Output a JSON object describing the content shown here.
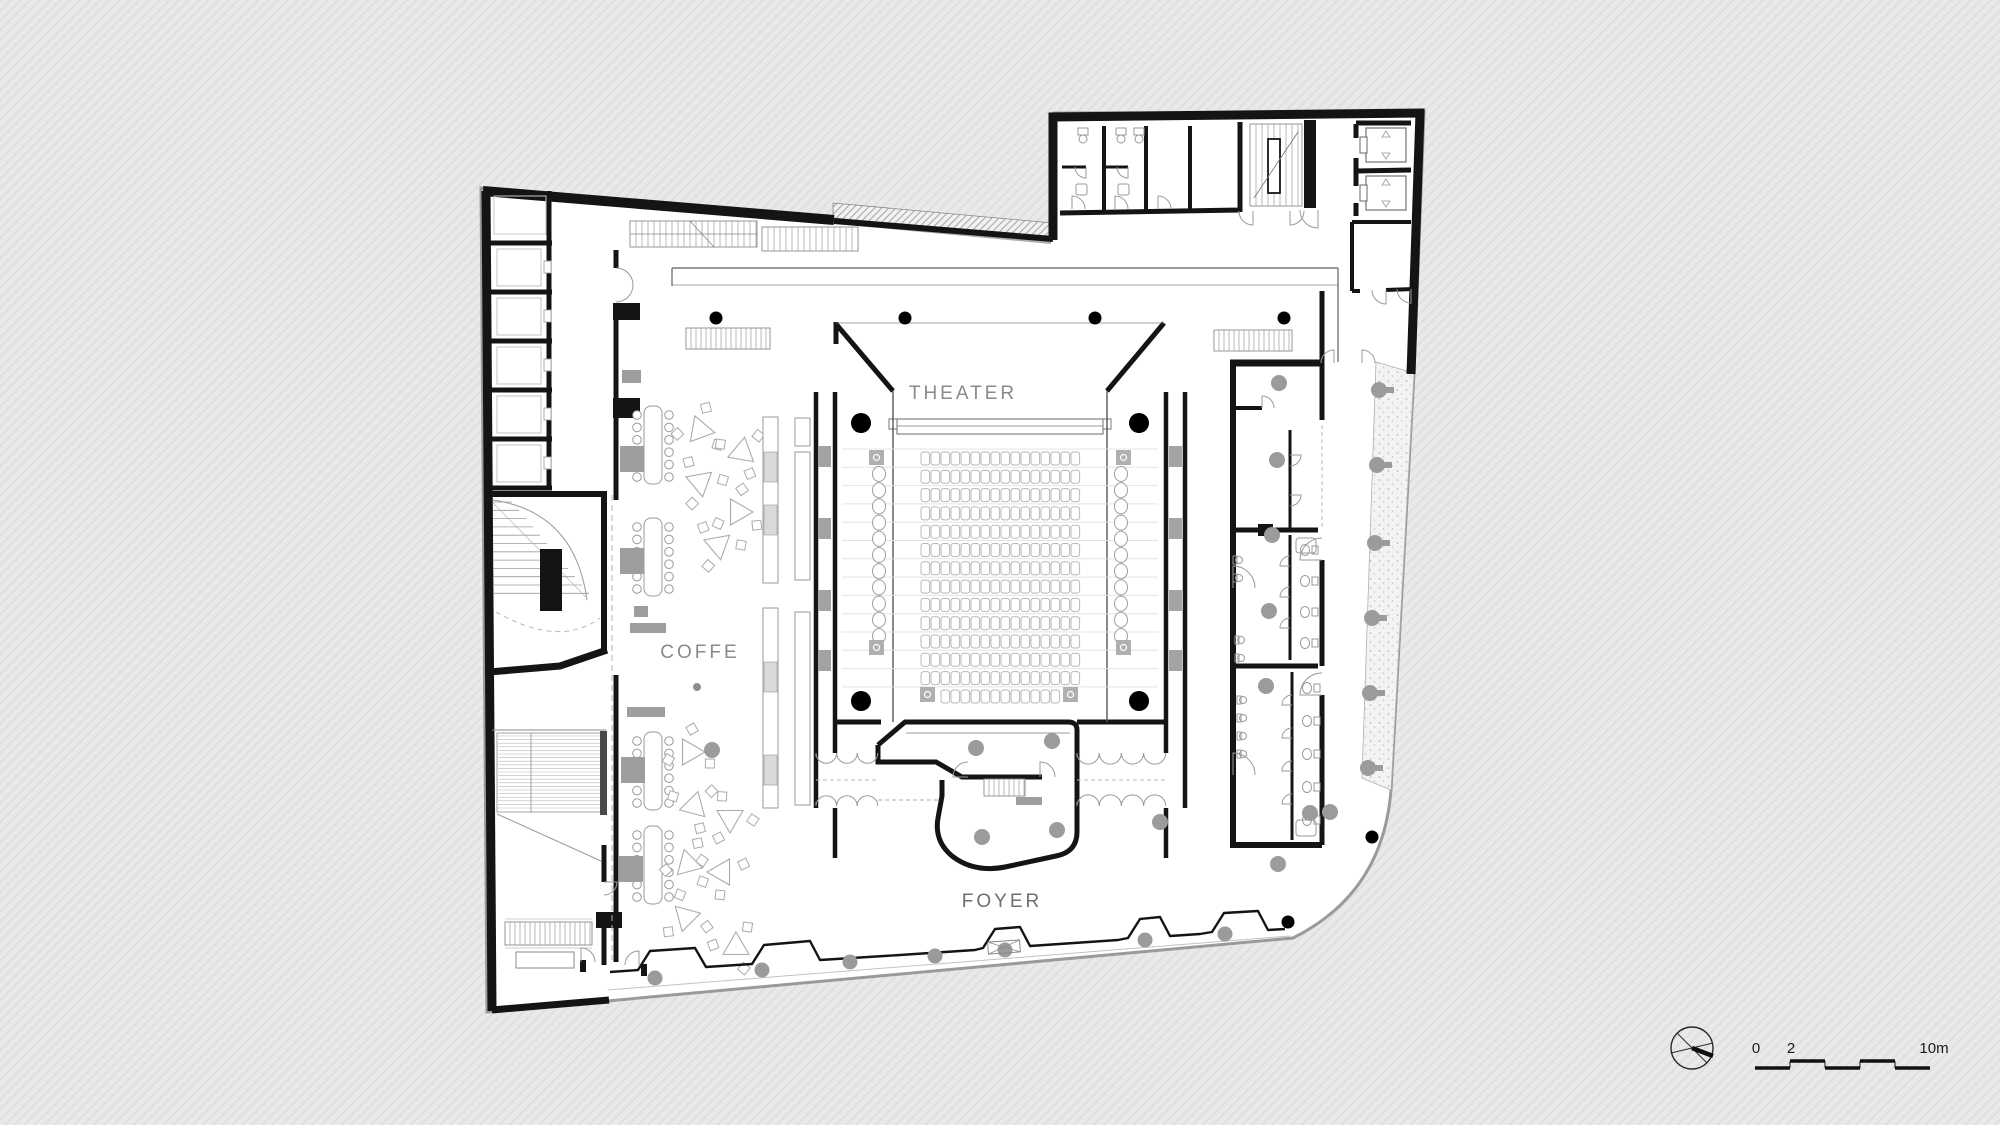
{
  "labels": {
    "theater": "THEATER",
    "coffe": "COFFE",
    "foyer": "FOYER"
  },
  "scale_bar": {
    "start_label": "0",
    "mid_label": "2",
    "end_label": "10m"
  },
  "theater": {
    "rows": 13,
    "seats_per_row": 16,
    "back_row_seats": 12,
    "side_seats_per_side": 11
  },
  "building": {
    "left_side_cells": 5,
    "cafe_long_tables": 4,
    "stage_columns": 4
  },
  "colors": {
    "background": "#e9e9e9",
    "hatch_line": "#dcdcdc",
    "wall": "#141414",
    "floor": "#ffffff",
    "furniture_line": "#a8a8a8",
    "column_black": "#000000",
    "column_gray": "#9b9b9b",
    "boundary": "#9a9a9a",
    "label_text": "#7d7d7d"
  }
}
